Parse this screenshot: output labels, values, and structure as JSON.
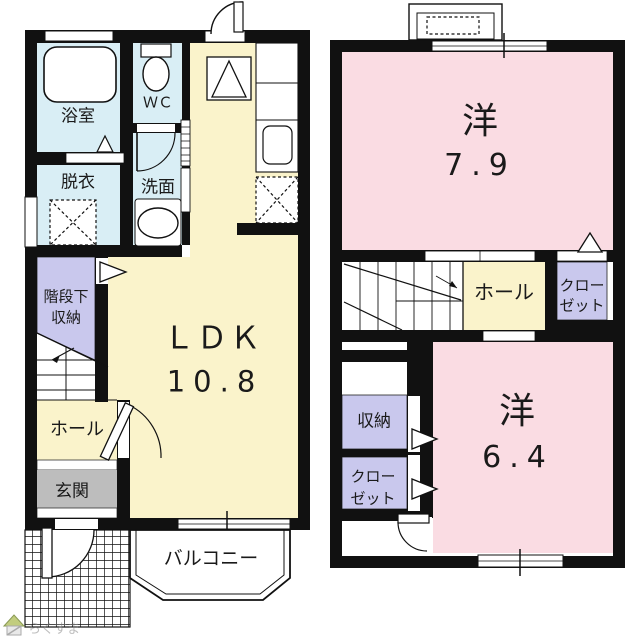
{
  "floor1": {
    "bath": "浴室",
    "wc": "ＷＣ",
    "dressing": "脱衣",
    "washroom": "洗面",
    "understair_storage": [
      "階段下",
      "収納"
    ],
    "hall": "ホール",
    "entrance": "玄関",
    "ldk_label": "ＬＤＫ",
    "ldk_size": "10.8",
    "balcony": "バルコニー"
  },
  "floor2": {
    "room1_label": "洋",
    "room1_size": "7.9",
    "hall": "ホール",
    "closet_upper": [
      "クロー",
      "ゼット"
    ],
    "storage": "収納",
    "closet_lower": [
      "クロー",
      "ゼット"
    ],
    "room2_label": "洋",
    "room2_size": "6.4"
  },
  "watermark": "らくすま",
  "colors": {
    "wall": "#111111",
    "ldk_yellow": "#faf3cb",
    "wet_blue": "#d9eef5",
    "storage_purple": "#c9c8ed",
    "bedroom_pink": "#fadce3",
    "entrance_gray": "#bdbdbd"
  }
}
